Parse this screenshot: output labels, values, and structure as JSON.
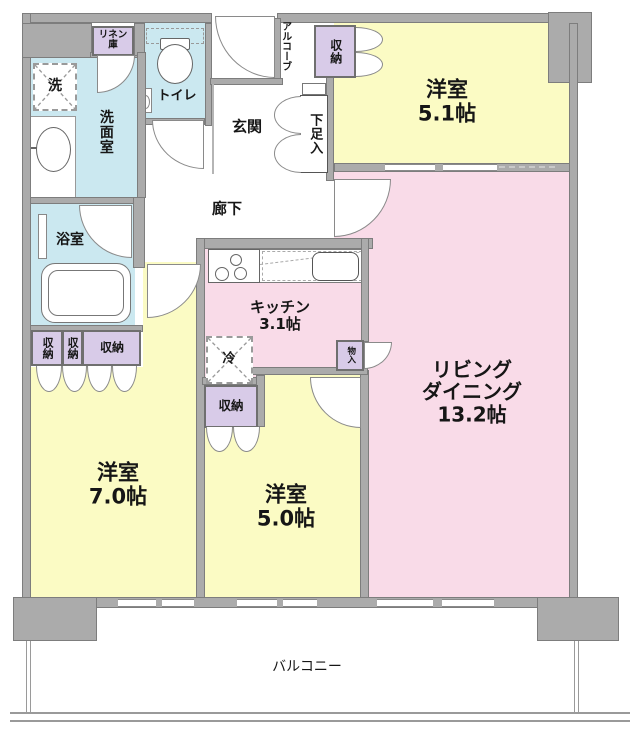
{
  "floorplan": {
    "rooms": {
      "western_51": {
        "name": "洋室",
        "size": "5.1帖"
      },
      "living_dining": {
        "line1": "リビング",
        "line2": "ダイニング",
        "size": "13.2帖"
      },
      "western_70": {
        "name": "洋室",
        "size": "7.0帖"
      },
      "western_50": {
        "name": "洋室",
        "size": "5.0帖"
      },
      "kitchen": {
        "name": "キッチン",
        "size": "3.1帖"
      },
      "entrance": "玄関",
      "hallway": "廊下",
      "toilet": "トイレ",
      "washroom": "洗面室",
      "bathroom": "浴室",
      "alcove": "アルコーブ",
      "balcony": "バルコニー"
    },
    "storage": {
      "linen": "リネン庫",
      "shoe_cabinet": "下足入",
      "closet": "収納",
      "mono_ire": "物入"
    },
    "appliances": {
      "washer": "洗",
      "fridge": "冷"
    },
    "colors": {
      "wall": "#ababab",
      "room_yellow": "#fbfbc4",
      "room_pink": "#f9dbe8",
      "room_blue": "#cbe8f0",
      "storage_purple": "#d8cbe8"
    }
  }
}
